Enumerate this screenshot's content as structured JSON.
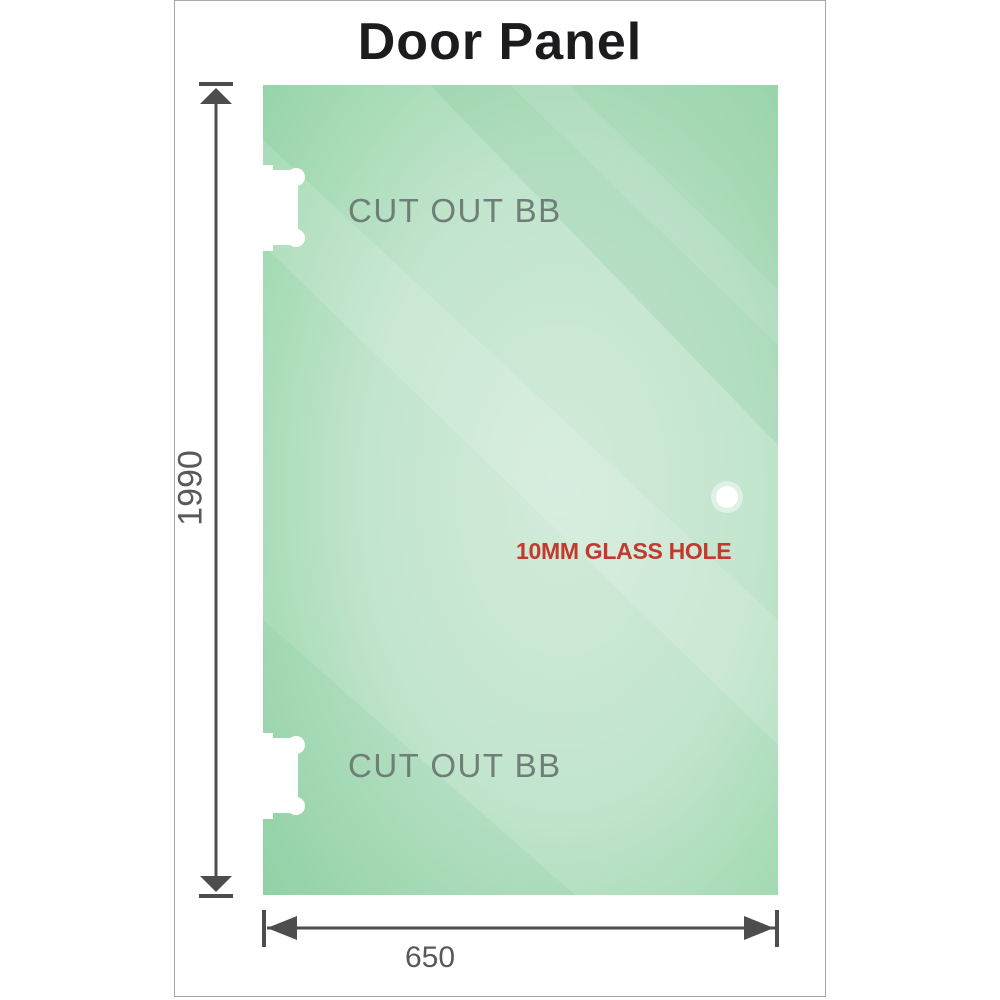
{
  "title": "Door Panel",
  "drawing": {
    "cutout_top": {
      "label": "CUT OUT BB"
    },
    "cutout_bottom": {
      "label": "CUT OUT BB"
    },
    "glass_hole": {
      "label": "10MM GLASS HOLE"
    },
    "dimensions": {
      "height": "1990",
      "width": "650"
    }
  },
  "colors": {
    "glass_green_edge": "#8dd0a2",
    "glass_green_center": "#d2ebda",
    "cutout_white": "#ffffff",
    "dimension_line_gray": "#4d4d4d",
    "dimension_text_gray": "#58595b",
    "cutout_label_gray": "#6f7e77",
    "glass_hole_label_red": "#c23a2e",
    "title_color": "#1c1c1e",
    "frame_border_gray": "#a6a6a6"
  }
}
